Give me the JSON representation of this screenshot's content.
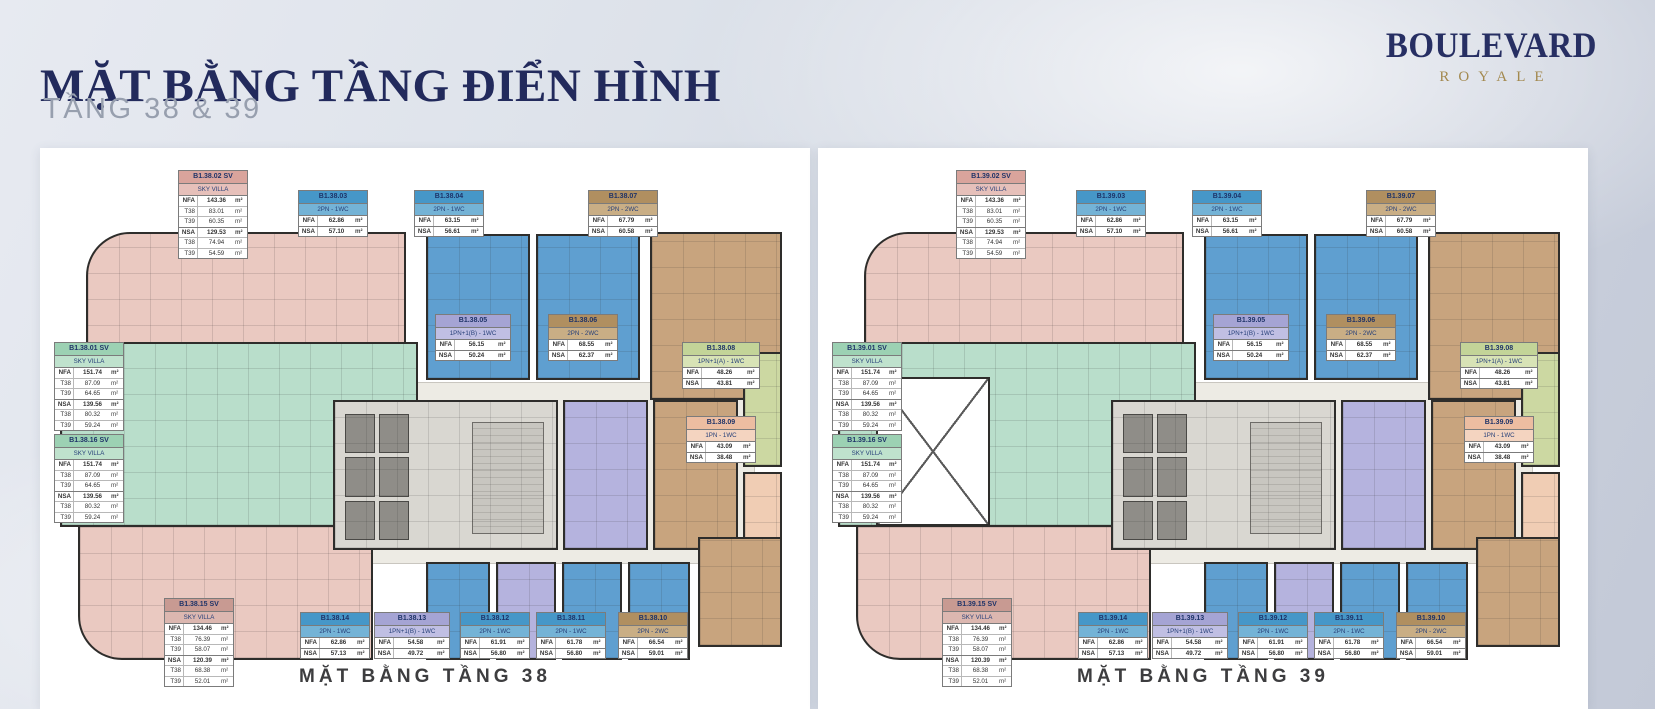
{
  "header": {
    "title": "MẶT BẰNG TẦNG ĐIỂN HÌNH",
    "subtitle": "TẦNG 38 & 39"
  },
  "logo": {
    "name": "BOULEVARD",
    "sub": "ROYALE"
  },
  "area_unit": "m²",
  "palette": {
    "pink": {
      "header": "#d9a49c",
      "light": "#e6c0ba"
    },
    "dusty": {
      "header": "#c89a92",
      "light": "#dcb7b0"
    },
    "green": {
      "header": "#9cd1b3",
      "light": "#bfe2cd"
    },
    "blue": {
      "header": "#4697c8",
      "light": "#74b3d6"
    },
    "purple": {
      "header": "#a5a4d4",
      "light": "#c0bfe3"
    },
    "brown": {
      "header": "#b08f60",
      "light": "#c9ae85"
    },
    "olive": {
      "header": "#c3d498",
      "light": "#d8e3b6"
    },
    "peach": {
      "header": "#ecbda1",
      "light": "#f4d4c0"
    }
  },
  "plans": [
    {
      "caption": "MẶT BẰNG TẦNG 38",
      "double_height_void": false,
      "units": {
        "u01": {
          "code": "B1.38.01 SV",
          "type": "SKY VILLA",
          "color": "green",
          "rows": [
            [
              "NFA",
              "151.74",
              1
            ],
            [
              "T38",
              "87.09",
              0
            ],
            [
              "T39",
              "64.65",
              0
            ],
            [
              "NSA",
              "139.56",
              1
            ],
            [
              "T38",
              "80.32",
              0
            ],
            [
              "T39",
              "59.24",
              0
            ]
          ]
        },
        "u02": {
          "code": "B1.38.02 SV",
          "type": "SKY VILLA",
          "color": "pink",
          "rows": [
            [
              "NFA",
              "143.36",
              1
            ],
            [
              "T38",
              "83.01",
              0
            ],
            [
              "T39",
              "60.35",
              0
            ],
            [
              "NSA",
              "129.53",
              1
            ],
            [
              "T38",
              "74.94",
              0
            ],
            [
              "T39",
              "54.59",
              0
            ]
          ]
        },
        "u03": {
          "code": "B1.38.03",
          "type": "2PN - 1WC",
          "color": "blue",
          "rows": [
            [
              "NFA",
              "62.86",
              1
            ],
            [
              "NSA",
              "57.10",
              1
            ]
          ]
        },
        "u04": {
          "code": "B1.38.04",
          "type": "2PN - 1WC",
          "color": "blue",
          "rows": [
            [
              "NFA",
              "63.15",
              1
            ],
            [
              "NSA",
              "56.61",
              1
            ]
          ]
        },
        "u05": {
          "code": "B1.38.05",
          "type": "1PN+1(B) - 1WC",
          "color": "purple",
          "rows": [
            [
              "NFA",
              "56.15",
              1
            ],
            [
              "NSA",
              "50.24",
              1
            ]
          ]
        },
        "u06": {
          "code": "B1.38.06",
          "type": "2PN - 2WC",
          "color": "brown",
          "rows": [
            [
              "NFA",
              "68.55",
              1
            ],
            [
              "NSA",
              "62.37",
              1
            ]
          ]
        },
        "u07": {
          "code": "B1.38.07",
          "type": "2PN - 2WC",
          "color": "brown",
          "rows": [
            [
              "NFA",
              "67.79",
              1
            ],
            [
              "NSA",
              "60.58",
              1
            ]
          ]
        },
        "u08": {
          "code": "B1.38.08",
          "type": "1PN+1(A) - 1WC",
          "color": "olive",
          "rows": [
            [
              "NFA",
              "48.26",
              1
            ],
            [
              "NSA",
              "43.81",
              1
            ]
          ]
        },
        "u09": {
          "code": "B1.38.09",
          "type": "1PN - 1WC",
          "color": "peach",
          "rows": [
            [
              "NFA",
              "43.09",
              1
            ],
            [
              "NSA",
              "38.48",
              1
            ]
          ]
        },
        "u10": {
          "code": "B1.38.10",
          "type": "2PN - 2WC",
          "color": "brown",
          "rows": [
            [
              "NFA",
              "66.54",
              1
            ],
            [
              "NSA",
              "59.01",
              1
            ]
          ]
        },
        "u11": {
          "code": "B1.38.11",
          "type": "2PN - 1WC",
          "color": "blue",
          "rows": [
            [
              "NFA",
              "61.78",
              1
            ],
            [
              "NSA",
              "56.80",
              1
            ]
          ]
        },
        "u12": {
          "code": "B1.38.12",
          "type": "2PN - 1WC",
          "color": "blue",
          "rows": [
            [
              "NFA",
              "61.91",
              1
            ],
            [
              "NSA",
              "56.80",
              1
            ]
          ]
        },
        "u13": {
          "code": "B1.38.13",
          "type": "1PN+1(B) - 1WC",
          "color": "purple",
          "rows": [
            [
              "NFA",
              "54.58",
              1
            ],
            [
              "NSA",
              "49.72",
              1
            ]
          ]
        },
        "u14": {
          "code": "B1.38.14",
          "type": "2PN - 1WC",
          "color": "blue",
          "rows": [
            [
              "NFA",
              "62.86",
              1
            ],
            [
              "NSA",
              "57.13",
              1
            ]
          ]
        },
        "u15": {
          "code": "B1.38.15 SV",
          "type": "SKY VILLA",
          "color": "dusty",
          "rows": [
            [
              "NFA",
              "134.46",
              1
            ],
            [
              "T38",
              "76.39",
              0
            ],
            [
              "T39",
              "58.07",
              0
            ],
            [
              "NSA",
              "120.39",
              1
            ],
            [
              "T38",
              "68.38",
              0
            ],
            [
              "T39",
              "52.01",
              0
            ]
          ]
        },
        "u16": {
          "code": "B1.38.16 SV",
          "type": "SKY VILLA",
          "color": "green",
          "rows": [
            [
              "NFA",
              "151.74",
              1
            ],
            [
              "T38",
              "87.09",
              0
            ],
            [
              "T39",
              "64.65",
              0
            ],
            [
              "NSA",
              "139.56",
              1
            ],
            [
              "T38",
              "80.32",
              0
            ],
            [
              "T39",
              "59.24",
              0
            ]
          ]
        }
      }
    },
    {
      "caption": "MẶT BẰNG TẦNG 39",
      "double_height_void": true,
      "units": {
        "u01": {
          "code": "B1.39.01 SV",
          "type": "SKY VILLA",
          "color": "green",
          "rows": [
            [
              "NFA",
              "151.74",
              1
            ],
            [
              "T38",
              "87.09",
              0
            ],
            [
              "T39",
              "64.65",
              0
            ],
            [
              "NSA",
              "139.56",
              1
            ],
            [
              "T38",
              "80.32",
              0
            ],
            [
              "T39",
              "59.24",
              0
            ]
          ]
        },
        "u02": {
          "code": "B1.39.02 SV",
          "type": "SKY VILLA",
          "color": "pink",
          "rows": [
            [
              "NFA",
              "143.36",
              1
            ],
            [
              "T38",
              "83.01",
              0
            ],
            [
              "T39",
              "60.35",
              0
            ],
            [
              "NSA",
              "129.53",
              1
            ],
            [
              "T38",
              "74.94",
              0
            ],
            [
              "T39",
              "54.59",
              0
            ]
          ]
        },
        "u03": {
          "code": "B1.39.03",
          "type": "2PN - 1WC",
          "color": "blue",
          "rows": [
            [
              "NFA",
              "62.86",
              1
            ],
            [
              "NSA",
              "57.10",
              1
            ]
          ]
        },
        "u04": {
          "code": "B1.39.04",
          "type": "2PN - 1WC",
          "color": "blue",
          "rows": [
            [
              "NFA",
              "63.15",
              1
            ],
            [
              "NSA",
              "56.61",
              1
            ]
          ]
        },
        "u05": {
          "code": "B1.39.05",
          "type": "1PN+1(B) - 1WC",
          "color": "purple",
          "rows": [
            [
              "NFA",
              "56.15",
              1
            ],
            [
              "NSA",
              "50.24",
              1
            ]
          ]
        },
        "u06": {
          "code": "B1.39.06",
          "type": "2PN - 2WC",
          "color": "brown",
          "rows": [
            [
              "NFA",
              "68.55",
              1
            ],
            [
              "NSA",
              "62.37",
              1
            ]
          ]
        },
        "u07": {
          "code": "B1.39.07",
          "type": "2PN - 2WC",
          "color": "brown",
          "rows": [
            [
              "NFA",
              "67.79",
              1
            ],
            [
              "NSA",
              "60.58",
              1
            ]
          ]
        },
        "u08": {
          "code": "B1.39.08",
          "type": "1PN+1(A) - 1WC",
          "color": "olive",
          "rows": [
            [
              "NFA",
              "48.26",
              1
            ],
            [
              "NSA",
              "43.81",
              1
            ]
          ]
        },
        "u09": {
          "code": "B1.39.09",
          "type": "1PN - 1WC",
          "color": "peach",
          "rows": [
            [
              "NFA",
              "43.09",
              1
            ],
            [
              "NSA",
              "38.48",
              1
            ]
          ]
        },
        "u10": {
          "code": "B1.39.10",
          "type": "2PN - 2WC",
          "color": "brown",
          "rows": [
            [
              "NFA",
              "66.54",
              1
            ],
            [
              "NSA",
              "59.01",
              1
            ]
          ]
        },
        "u11": {
          "code": "B1.39.11",
          "type": "2PN - 1WC",
          "color": "blue",
          "rows": [
            [
              "NFA",
              "61.78",
              1
            ],
            [
              "NSA",
              "56.80",
              1
            ]
          ]
        },
        "u12": {
          "code": "B1.39.12",
          "type": "2PN - 1WC",
          "color": "blue",
          "rows": [
            [
              "NFA",
              "61.91",
              1
            ],
            [
              "NSA",
              "56.80",
              1
            ]
          ]
        },
        "u13": {
          "code": "B1.39.13",
          "type": "1PN+1(B) - 1WC",
          "color": "purple",
          "rows": [
            [
              "NFA",
              "54.58",
              1
            ],
            [
              "NSA",
              "49.72",
              1
            ]
          ]
        },
        "u14": {
          "code": "B1.39.14",
          "type": "2PN - 1WC",
          "color": "blue",
          "rows": [
            [
              "NFA",
              "62.86",
              1
            ],
            [
              "NSA",
              "57.13",
              1
            ]
          ]
        },
        "u15": {
          "code": "B1.39.15 SV",
          "type": "SKY VILLA",
          "color": "dusty",
          "rows": [
            [
              "NFA",
              "134.46",
              1
            ],
            [
              "T38",
              "76.39",
              0
            ],
            [
              "T39",
              "58.07",
              0
            ],
            [
              "NSA",
              "120.39",
              1
            ],
            [
              "T38",
              "68.38",
              0
            ],
            [
              "T39",
              "52.01",
              0
            ]
          ]
        },
        "u16": {
          "code": "B1.39.16 SV",
          "type": "SKY VILLA",
          "color": "green",
          "rows": [
            [
              "NFA",
              "151.74",
              1
            ],
            [
              "T38",
              "87.09",
              0
            ],
            [
              "T39",
              "64.65",
              0
            ],
            [
              "NSA",
              "139.56",
              1
            ],
            [
              "T38",
              "80.32",
              0
            ],
            [
              "T39",
              "59.24",
              0
            ]
          ]
        }
      }
    }
  ]
}
